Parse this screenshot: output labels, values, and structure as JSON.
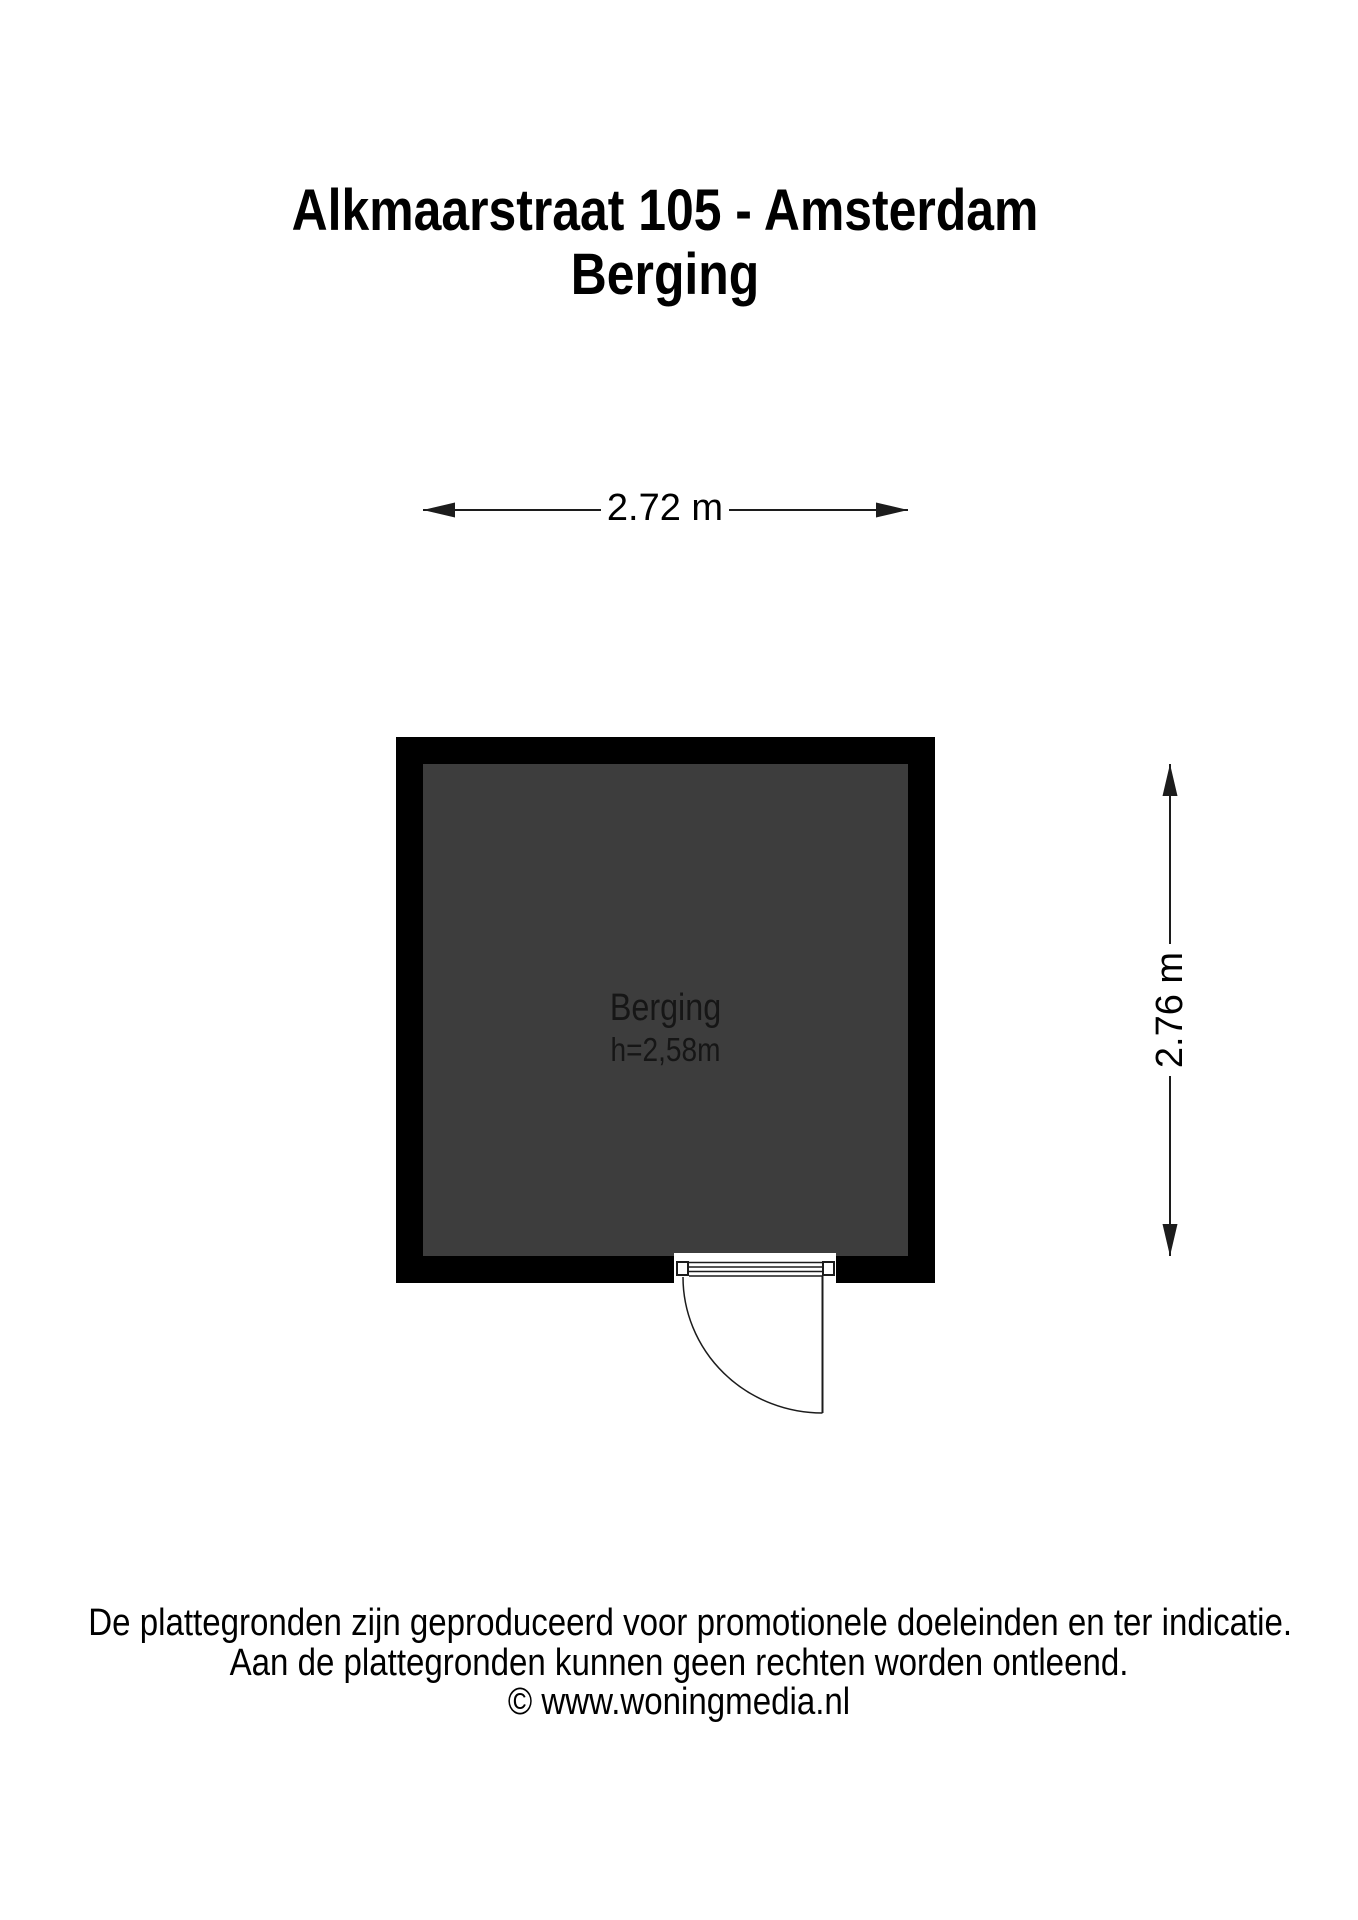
{
  "title": {
    "line1": "Alkmaarstraat 105 - Amsterdam",
    "line2": "Berging"
  },
  "dimensions": {
    "width_label": "2.72 m",
    "height_label": "2.76 m"
  },
  "room": {
    "name": "Berging",
    "height_label": "h=2,58m"
  },
  "footer": {
    "line1": "De plattegronden zijn geproduceerd voor promotionele doeleinden en ter indicatie.",
    "line2": "Aan de plattegronden kunnen geen rechten worden ontleend.",
    "line3": "© www.woningmedia.nl"
  },
  "colors": {
    "wall": "#000000",
    "floor": "#3d3d3d",
    "line": "#1c1c1c",
    "background": "#ffffff",
    "text": "#000000"
  }
}
